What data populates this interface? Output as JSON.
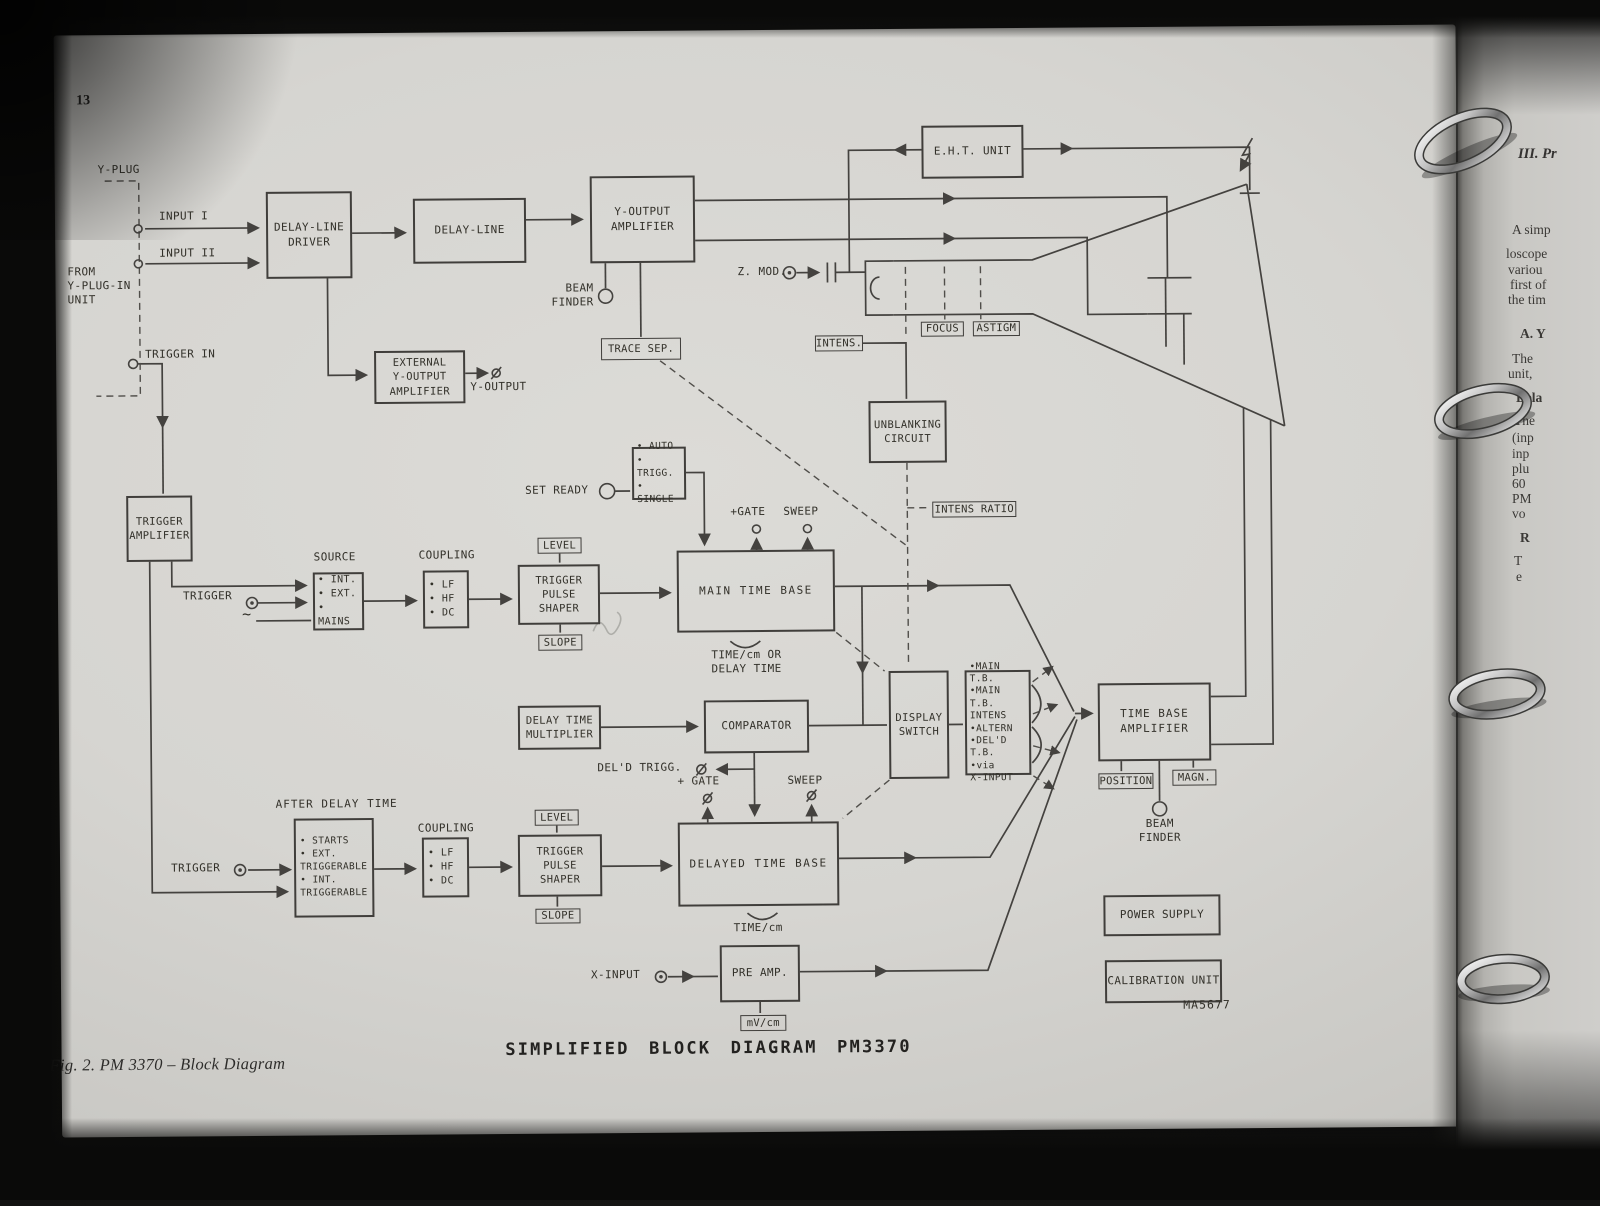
{
  "page": {
    "number": "13",
    "title": "SIMPLIFIED BLOCK DIAGRAM PM3370",
    "caption": "Fig. 2.  PM 3370 – Block Diagram",
    "code": "MA5677"
  },
  "blocks": {
    "delay_line_driver": "DELAY-LINE\nDRIVER",
    "delay_line": "DELAY-LINE",
    "y_output_amplifier": "Y-OUTPUT\nAMPLIFIER",
    "eht_unit": "E.H.T. UNIT",
    "external_y_output_amplifier": "EXTERNAL\nY-OUTPUT\nAMPLIFIER",
    "trace_sep": "TRACE SEP.",
    "trigger_amplifier": "TRIGGER\nAMPLIFIER",
    "unblanking_circuit": "UNBLANKING\nCIRCUIT",
    "intens": "INTENS.",
    "focus": "FOCUS",
    "astigm": "ASTIGM",
    "mode": "• AUTO\n• TRIGG.\n• SINGLE",
    "source": "• INT.\n• EXT.\n• MAINS",
    "coupling1": "• LF\n• HF\n• DC",
    "level1": "LEVEL",
    "slope1": "SLOPE",
    "trigger_pulse_shaper1": "TRIGGER\nPULSE\nSHAPER",
    "main_time_base": "MAIN TIME BASE",
    "intens_ratio": "INTENS RATIO",
    "delay_time_multiplier": "DELAY TIME\nMULTIPLIER",
    "comparator": "COMPARATOR",
    "display_switch": "DISPLAY\nSWITCH",
    "display_modes": "•MAIN T.B.\n•MAIN T.B.\n INTENS\n•ALTERN\n•DEL'D T.B.\n•via\n X-INPUT",
    "time_base_amplifier": "TIME BASE\nAMPLIFIER",
    "position": "POSITION",
    "magn": "MAGN.",
    "after_delay_time": "• STARTS\n• EXT.\nTRIGGERABLE\n• INT.\nTRIGGERABLE",
    "coupling2": "• LF\n• HF\n• DC",
    "level2": "LEVEL",
    "slope2": "SLOPE",
    "trigger_pulse_shaper2": "TRIGGER\nPULSE\nSHAPER",
    "delayed_time_base": "DELAYED TIME BASE",
    "pre_amp": "PRE AMP.",
    "mv_cm": "mV/cm",
    "power_supply": "POWER SUPPLY",
    "calibration_unit": "CALIBRATION UNIT"
  },
  "labels": {
    "y_plug": "Y-PLUG",
    "input_1": "INPUT I",
    "input_2": "INPUT II",
    "from_y_plugin": "FROM\nY-PLUG-IN\nUNIT",
    "trigger_in": "TRIGGER IN",
    "beam_finder_top": "BEAM\nFINDER",
    "z_mod": "Z. MOD.",
    "y_output": "Y-OUTPUT",
    "set_ready": "SET READY",
    "source_title": "SOURCE",
    "coupling_title1": "COUPLING",
    "trigger1": "TRIGGER",
    "mains_tilde": "~",
    "gate_main": "+GATE",
    "sweep_main": "SWEEP",
    "timecm_or": "TIME/cm OR\nDELAY TIME",
    "deld_trigg": "DEL'D  TRIGG.",
    "gate_del": "+ GATE",
    "sweep_del": "SWEEP",
    "after_delay_title": "AFTER DELAY TIME",
    "coupling_title2": "COUPLING",
    "trigger2": "TRIGGER",
    "timecm": "TIME/cm",
    "x_input": "X-INPUT",
    "beam_finder_bottom": "BEAM\nFINDER"
  },
  "right_page": {
    "heading": "III. Pr",
    "lines": [
      "A simp",
      "loscope",
      "variou",
      "first of",
      "the tim",
      "A. Y",
      "The",
      "unit,",
      "Dela",
      "The",
      "(inp",
      "inp",
      "plu",
      "60",
      "PM",
      "vo",
      "R",
      "T",
      "e"
    ]
  }
}
